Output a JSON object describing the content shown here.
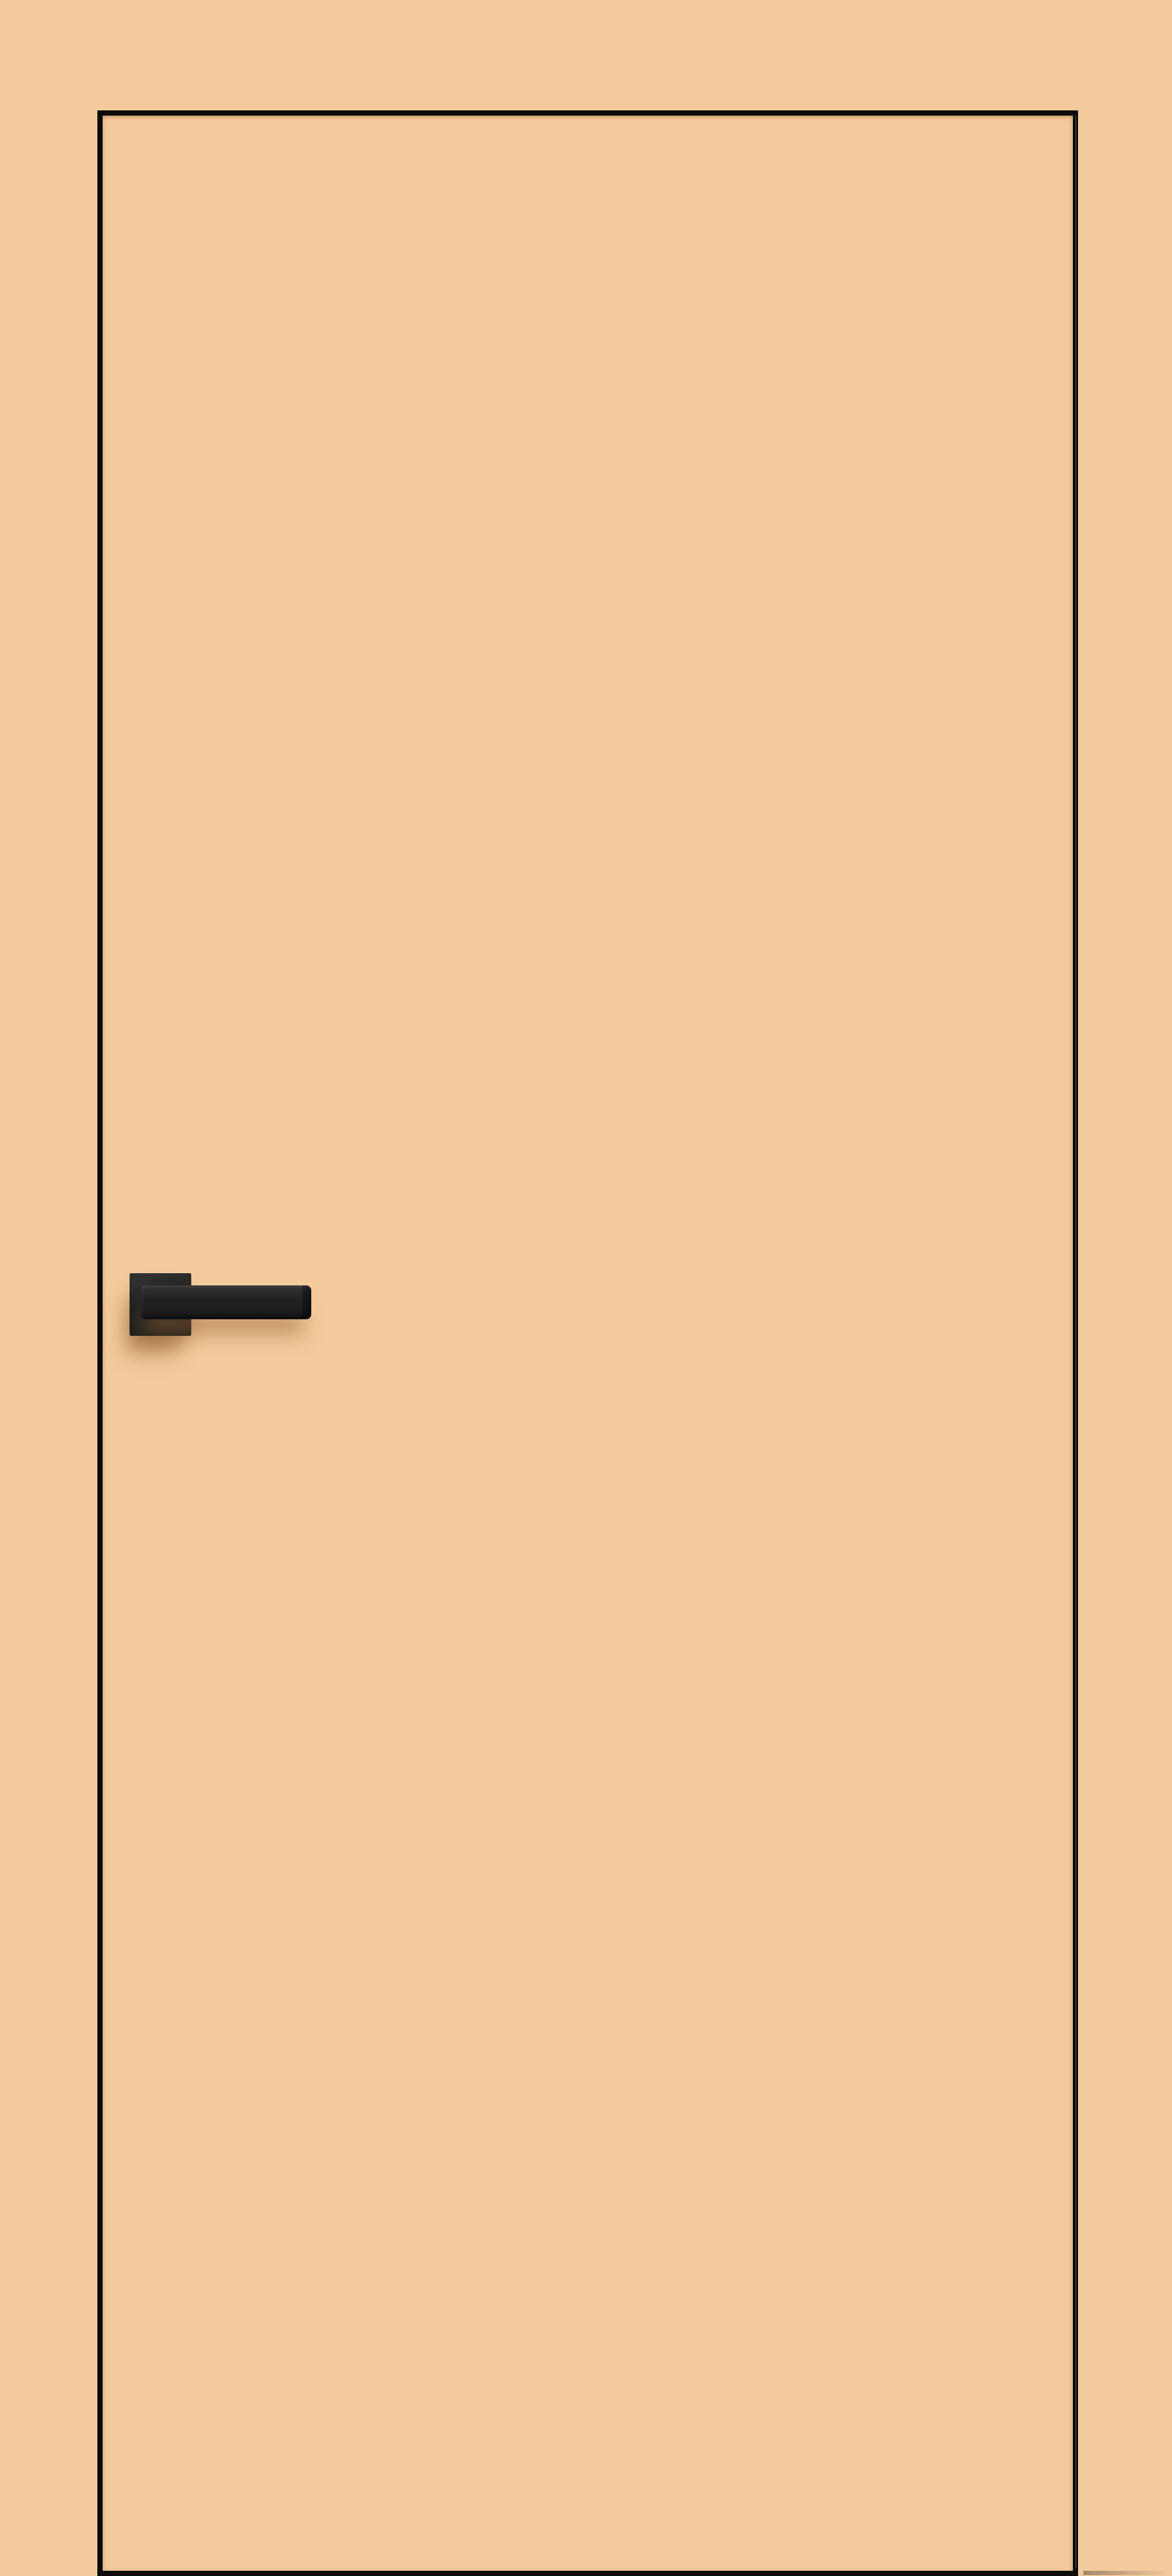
{
  "scene": {
    "subject": "Flat flush interior door in peach finish with thin black concealed-frame edge outline and matte black square-rosette lever handle on the left side",
    "visible_text": "",
    "handle_side": "left"
  },
  "colors": {
    "wall": "#F3CA9C",
    "door_leaf": "#F3CA9C",
    "outline": "#0D0C0A",
    "handle_body": "#222222",
    "handle_light": "#343434",
    "handle_dark": "#1A1A1A",
    "shadow_tint": "#966334"
  }
}
